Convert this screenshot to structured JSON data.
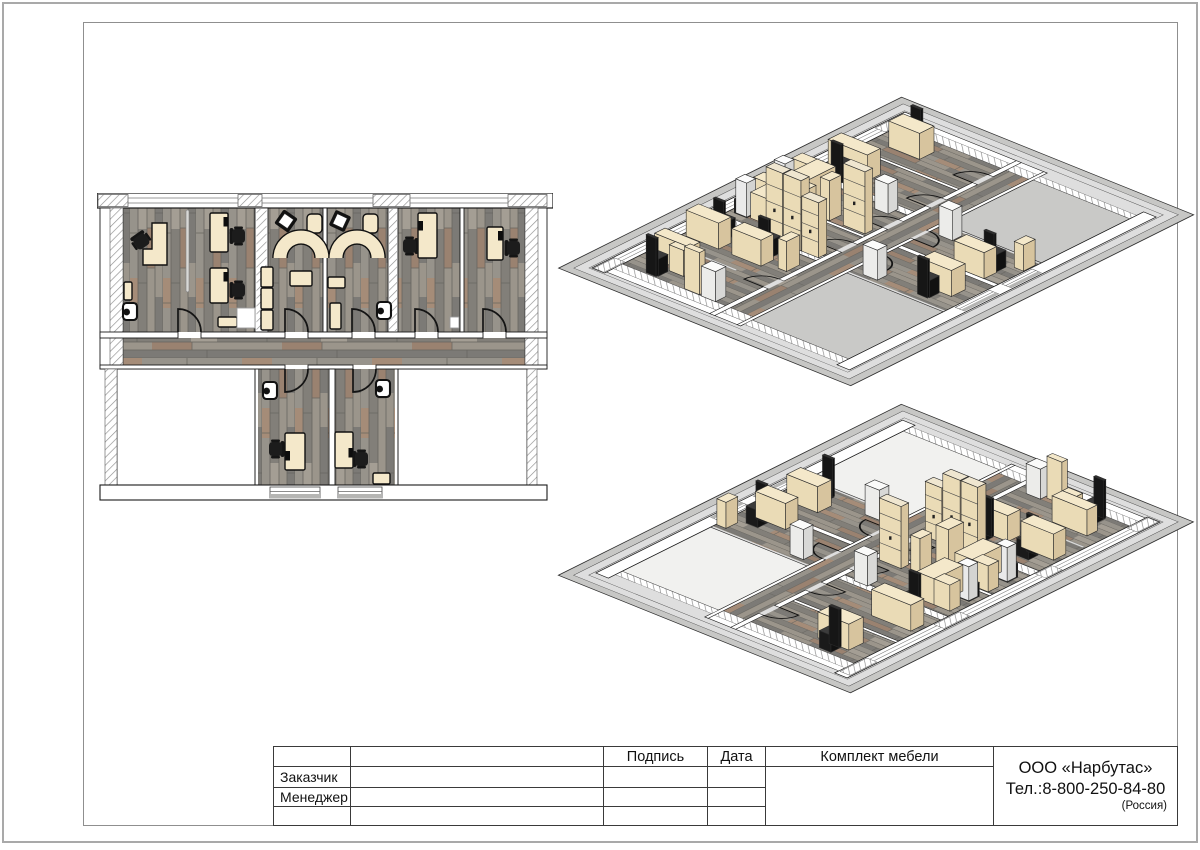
{
  "title_block": {
    "col_headers": {
      "signature": "Подпись",
      "date": "Дата",
      "furniture_set": "Комплект мебели"
    },
    "row_labels": {
      "customer": "Заказчик",
      "manager": "Менеджер"
    },
    "company": {
      "name": "ООО «Нарбутас»",
      "phone": "Тел.:8-800-250-84-80",
      "country": "(Россия)"
    }
  },
  "palette": {
    "wood_base": "#8d8a83",
    "wood_warm": "#9a8270",
    "furniture_top": "#f4e8ca",
    "furniture_light": "#eadbb6",
    "furniture_dark": "#d7c49e",
    "chair_black": "#1c1c1c",
    "room_white_2d": "#ffffff",
    "room_gray_iso1": "#c9c9c7",
    "room_gray_iso2": "#f1f1ef",
    "plate_gray": "#c7c7c5",
    "frame_gray": "#8f8f8f",
    "line_black": "#111111"
  }
}
